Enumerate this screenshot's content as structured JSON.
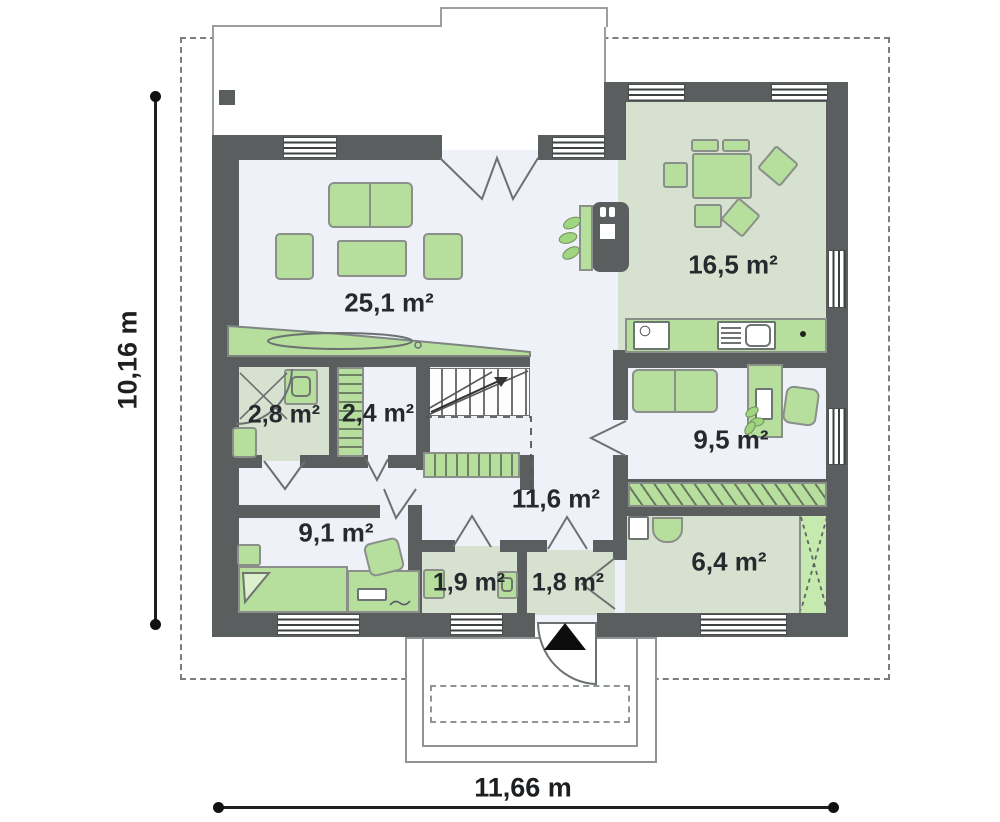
{
  "plan_title": "Single-storey house floor plan",
  "dimensions": {
    "total_width_label": "11,66 m",
    "total_height_label": "10,16 m"
  },
  "rooms": {
    "living": {
      "label": "25,1 m²"
    },
    "kitchen": {
      "label": "16,5 m²"
    },
    "bath_small": {
      "label": "2,8 m²"
    },
    "closet": {
      "label": "2,4 m²"
    },
    "bedroom": {
      "label": "9,1 m²"
    },
    "office": {
      "label": "9,5 m²"
    },
    "hall": {
      "label": "11,6 m²"
    },
    "wc": {
      "label": "1,9 m²"
    },
    "vestibule": {
      "label": "1,8 m²"
    },
    "bath_large": {
      "label": "6,4 m²"
    }
  },
  "colors": {
    "wall": "#5b5e5e",
    "floor_light": "#eff1f9",
    "floor_green": "#d6e1cf",
    "furniture_green": "#b6df9e",
    "boundary_dash": "#7d7d7d"
  }
}
